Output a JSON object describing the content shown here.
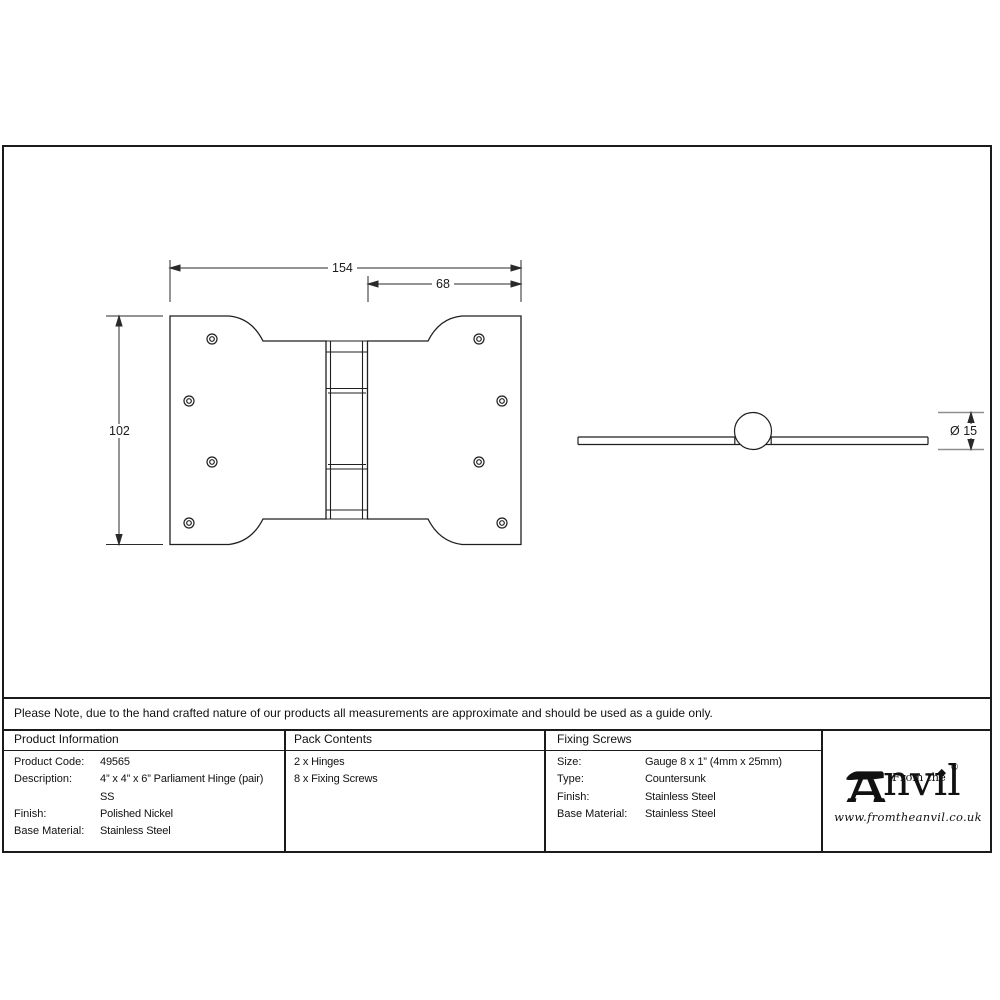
{
  "dimensions": {
    "overall_width": "154",
    "leaf_width": "68",
    "height": "102",
    "pin_diameter": "Ø 15"
  },
  "note": "Please Note, due to the hand crafted nature of our products all measurements are approximate and should be used as a guide only.",
  "product_information": {
    "header": "Product Information",
    "rows": [
      {
        "label": "Product Code:",
        "value": "49565"
      },
      {
        "label": "Description:",
        "value": "4” x 4” x 6” Parliament Hinge (pair)"
      },
      {
        "label": "",
        "value": "SS"
      },
      {
        "label": "Finish:",
        "value": "Polished Nickel"
      },
      {
        "label": "Base Material:",
        "value": "Stainless Steel"
      }
    ]
  },
  "pack_contents": {
    "header": "Pack Contents",
    "items": [
      "2 x Hinges",
      "8 x Fixing Screws"
    ]
  },
  "fixing_screws": {
    "header": "Fixing Screws",
    "rows": [
      {
        "label": "Size:",
        "value": "Gauge 8 x 1” (4mm x 25mm)"
      },
      {
        "label": "Type:",
        "value": "Countersunk"
      },
      {
        "label": "Finish:",
        "value": "Stainless Steel"
      },
      {
        "label": "Base Material:",
        "value": "Stainless Steel"
      }
    ]
  },
  "logo": {
    "tagline": "From the",
    "brand": "Anvil",
    "brand_after_icon": "nvıl",
    "registered": "®",
    "website": "www.fromtheanvil.co.uk"
  },
  "colors": {
    "line": "#1f1f1f",
    "border": "#1b1b1b",
    "background": "#ffffff"
  }
}
